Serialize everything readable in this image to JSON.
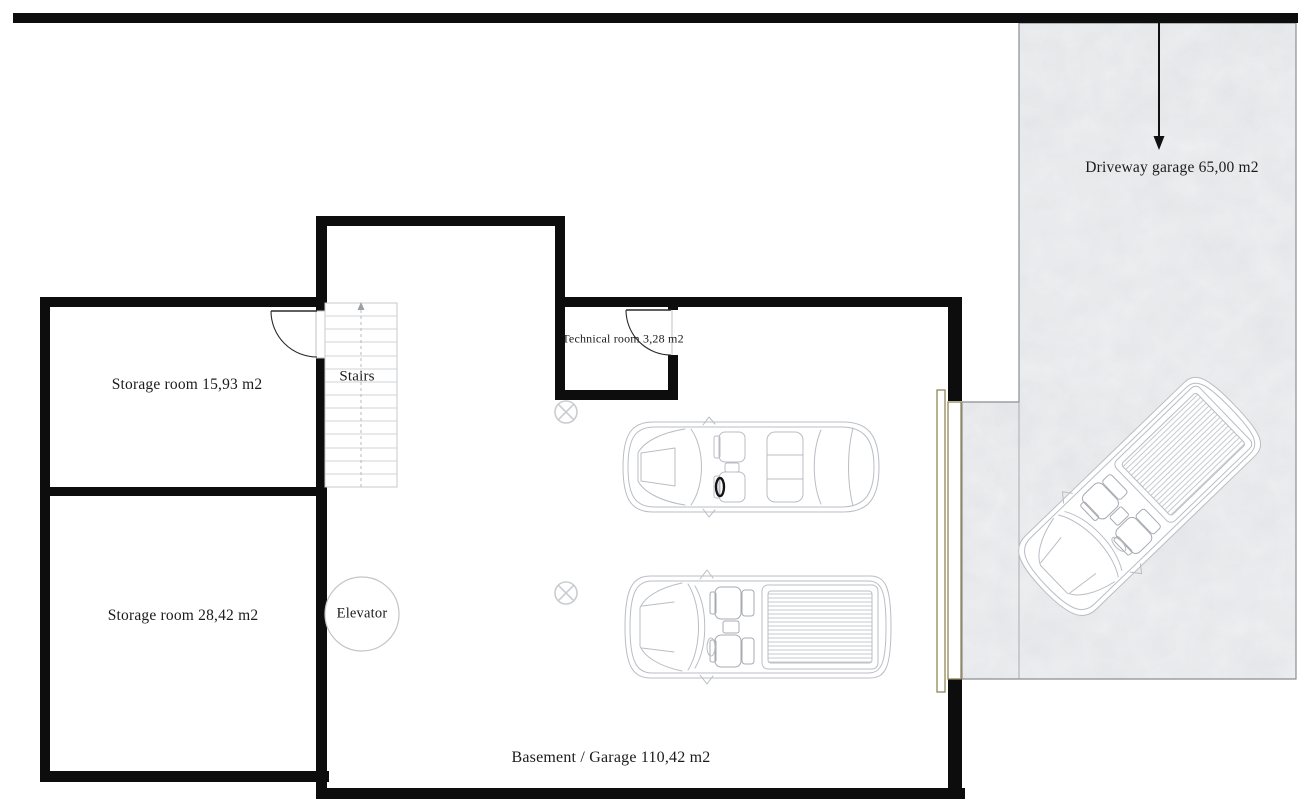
{
  "labels": {
    "storage_room_1": "Storage room 15,93 m2",
    "storage_room_2": "Storage room 28,42 m2",
    "stairs": "Stairs",
    "technical_room": "Technical room 3,28 m2",
    "elevator": "Elevator",
    "basement_garage": "Basement / Garage 110,42 m2",
    "driveway_garage": "Driveway garage 65,00 m2"
  },
  "icons": {
    "ceiling_light": "circled-x",
    "stairs_direction_arrow": "up",
    "driveway_entry_arrow": "down"
  },
  "vehicles": [
    {
      "type": "sedan",
      "location": "garage"
    },
    {
      "type": "pickup-truck",
      "location": "garage"
    },
    {
      "type": "pickup-truck",
      "location": "driveway"
    }
  ],
  "colors": {
    "wall": "#0d0d0d",
    "car_outline": "#b9bdc3",
    "garage_door_frame": "#8f8758",
    "marble_floor": "#eff0f2",
    "text": "#1b1b1b"
  }
}
